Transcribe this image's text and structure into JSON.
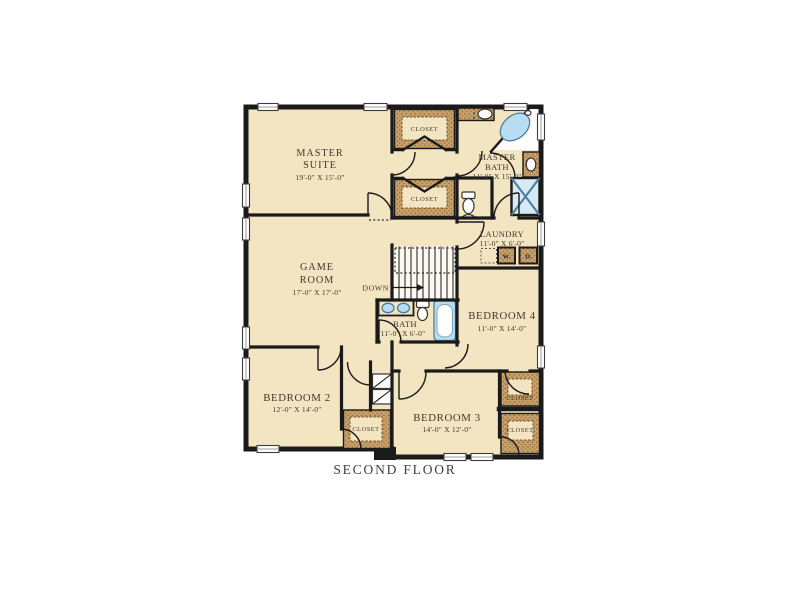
{
  "caption": "SECOND FLOOR",
  "rooms": {
    "master_suite": {
      "name_line1": "MASTER",
      "name_line2": "SUITE",
      "dims": "19'-0\" X 15'-0\""
    },
    "master_bath": {
      "name_line1": "MASTER",
      "name_line2": "BATH",
      "dims": "11'-0\" X 15'-0\""
    },
    "game_room": {
      "name_line1": "GAME",
      "name_line2": "ROOM",
      "dims": "17'-0\" X 17'-0\""
    },
    "laundry": {
      "name": "LAUNDRY",
      "dims": "11'-0\" X 6'-0\""
    },
    "bath": {
      "name": "BATH",
      "dims": "11'-0\" X 6'-0\""
    },
    "bedroom_2": {
      "name": "BEDROOM 2",
      "dims": "12'-0\" X 14'-0\""
    },
    "bedroom_3": {
      "name": "BEDROOM 3",
      "dims": "14'-0\" X 12'-0\""
    },
    "bedroom_4": {
      "name": "BEDROOM 4",
      "dims": "11'-0\" X 14'-0\""
    }
  },
  "closets": {
    "master_top": "CLOSET",
    "master_bottom": "CLOSET",
    "bedroom2": "CLOSET",
    "bedroom4": "CLOSET",
    "bedroom3": "CLOSET"
  },
  "stairs": {
    "down_label": "DOWN"
  },
  "appliances": {
    "washer": "W.",
    "dryer": "D."
  },
  "colors": {
    "floor": "#f3e4c2",
    "closet_band": "#c7a06a",
    "closet_dots": "#8a6134",
    "wall": "#1a1a1a",
    "fixture_blue": "#b9ddf0",
    "shower_blue": "#d6eaf5",
    "text": "#42372a",
    "caption": "#3f3f3f",
    "background": "#ffffff"
  }
}
